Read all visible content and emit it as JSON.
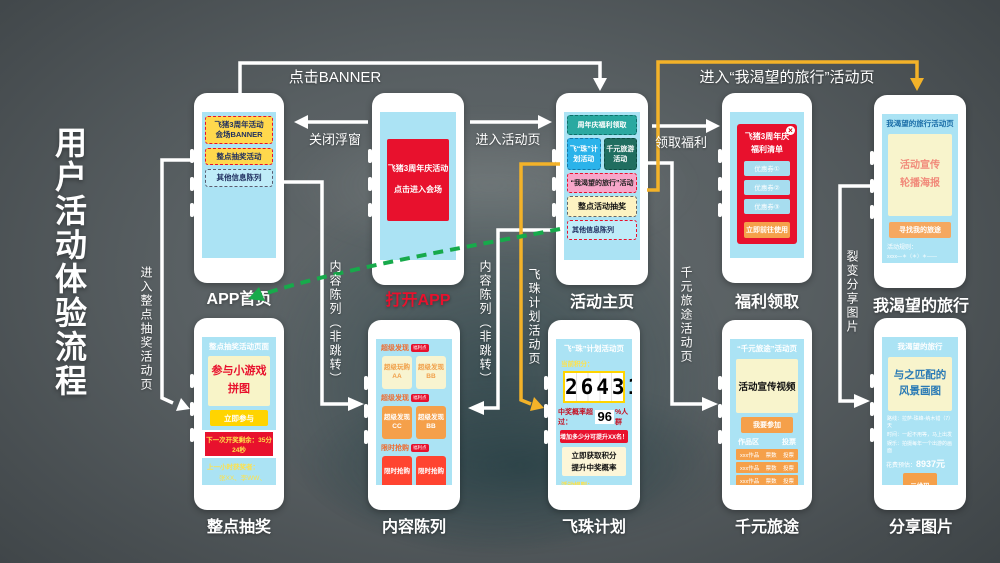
{
  "title": "用户活动体验流程",
  "colors": {
    "accent_red": "#e8112d",
    "accent_yellow": "#f3b229",
    "accent_green": "#17aa4b",
    "screen_blue": "#abe3f4",
    "banner_gold": "#ffd84d",
    "background_gray": "#596063"
  },
  "edges": {
    "click_banner": "点击BANNER",
    "close_float": "关闭浮窗",
    "enter_activity": "进入活动页",
    "claim_welfare": "领取福利",
    "enter_desired_trip": "进入“我渴望的旅行”活动页",
    "enter_hourly_draw": "进入整点抽奖活动页",
    "content_list_left": "内容陈列（非跳转）",
    "content_list_right": "内容陈列（非跳转）",
    "pearl_plan_page": "飞珠计划活动页",
    "thousand_trip_page": "千元旅途活动页",
    "fission_share_pic": "裂变分享图片",
    "open_app": "打开APP"
  },
  "phones": {
    "app_home": {
      "label": "APP首页",
      "banner": "飞猪3周年活动\n会场BANNER",
      "hourly_draw": "整点抽奖活动",
      "other_info": "其他信息陈列"
    },
    "open_app": {
      "splash": "飞猪3周年庆活动\n点击进入会场"
    },
    "activity_home": {
      "label": "活动主页",
      "welfare": "周年庆福利领取",
      "pearl_plan": "飞“珠”计划活动",
      "thousand_trip": "千元旅游活动",
      "desired_trip": "“我渴望的旅行”活动",
      "hourly_draw": "整点活动抽奖",
      "other_info": "其他信息陈列"
    },
    "welfare_claim": {
      "label": "福利领取",
      "popup_title": "飞猪3周年庆\n福利清单",
      "coupons": [
        "优惠券①",
        "优惠券②",
        "优惠券③"
      ],
      "cta": "立即前往使用",
      "close_glyph": "×"
    },
    "desired_trip": {
      "label": "我渴望的旅行",
      "header": "我渴望的旅行活动页",
      "poster": "活动宣传\n轮播海报",
      "cta": "寻找我的旅途",
      "rules_label": "活动规则：",
      "rules_text": "xxxx—＊（＊）＊——"
    },
    "hourly_draw": {
      "label": "整点抽奖",
      "header": "整点抽奖活动页面",
      "game": "参与小游戏\n拼图",
      "cta": "立即参与",
      "countdown": "下一次开奖剩余：35分24秒",
      "winners_label": "上一小时获奖者：",
      "winners": "张XX、李WW、王OO",
      "rules_label": "活动规则：",
      "rules_text": "这样-然后-再这样-然后-就是啦"
    },
    "content_list": {
      "label": "内容陈列",
      "sections": [
        {
          "header": "超级发现",
          "badge": "福利点",
          "box_a": "超级玩购\nAA",
          "box_b": "超级发现\nBB"
        },
        {
          "header": "超级发现",
          "badge": "福利点",
          "box_a": "超级发现\nCC",
          "box_b": "超级发现\nBB"
        },
        {
          "header": "限时抢购",
          "badge": "福利点",
          "box_a": "限时抢购",
          "box_b": "限时抢购"
        }
      ]
    },
    "pearl_plan": {
      "label": "飞珠计划",
      "header": "飞“珠”计划活动页",
      "points_label": "当前积分：",
      "points": "26431",
      "prob_prefix": "中奖概率超过：",
      "prob_value": "96",
      "prob_suffix": "%人群",
      "boost": "增加多少分可提升XX名！",
      "cta": "立即获取积分\n提升中奖概率",
      "rules_label": "活动规则："
    },
    "thousand_trip": {
      "label": "千元旅途",
      "header": "“千元旅途”活动页",
      "video": "活动宣传视频",
      "join": "我要参加",
      "col_works": "作品区",
      "col_vote": "投票",
      "rows": [
        {
          "name": "xxx作品",
          "votes": "票数",
          "vote": "投票"
        },
        {
          "name": "xxx作品",
          "votes": "票数",
          "vote": "投票"
        },
        {
          "name": "xxx作品",
          "votes": "票数",
          "vote": "投票"
        },
        {
          "name": "xxx作品",
          "votes": "票数",
          "vote": "投票"
        }
      ]
    },
    "share_pic": {
      "label": "分享图片",
      "header": "我渴望的旅行",
      "picture": "与之匹配的\n风景画图",
      "line1": "路线：拉萨-珠峰-纳木错（7）天",
      "line2": "时间：一起不用等，马上出发",
      "line3": "娱乐：拍摄每年一个出游的画面",
      "cost_label": "花费预估：",
      "cost": "8937元",
      "qr": "二维码",
      "footer": "扫码和我开启同款旅行计划"
    }
  }
}
